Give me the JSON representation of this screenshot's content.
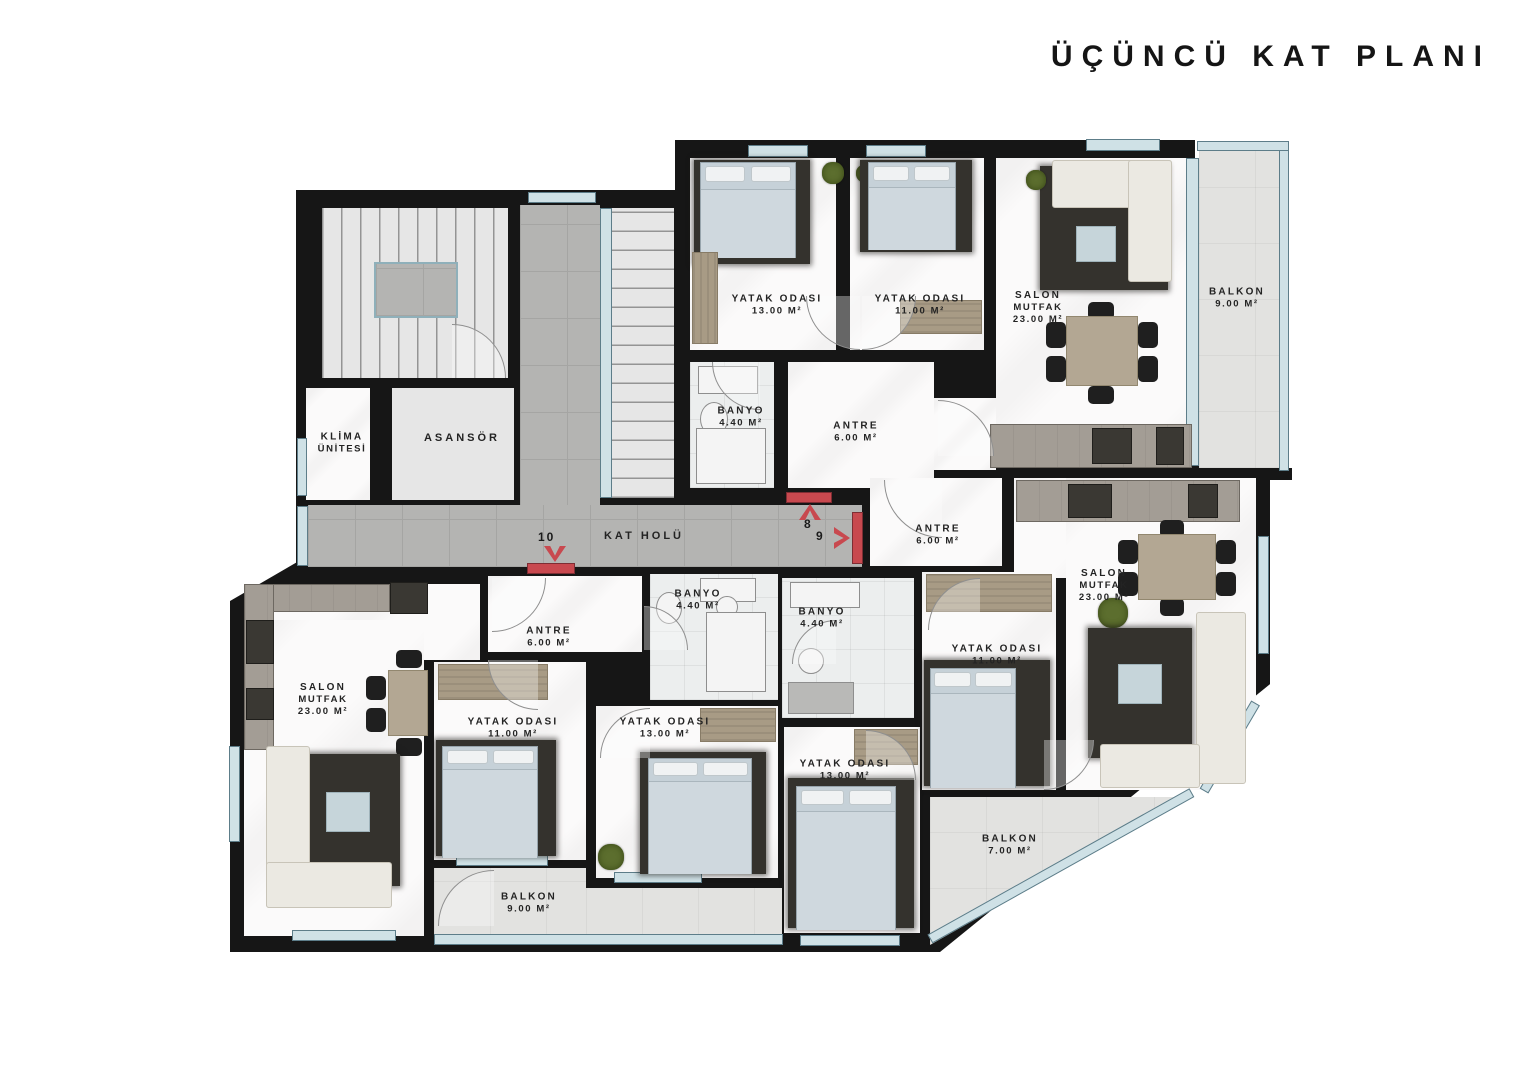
{
  "title": "ÜÇÜNCÜ KAT PLANI",
  "core": {
    "klima_line1": "KLİMA",
    "klima_line2": "ÜNİTESİ",
    "asansor": "ASANSÖR",
    "corridor": "KAT HOLÜ"
  },
  "markers": {
    "up": "8",
    "right": "9",
    "down": "10"
  },
  "rooms": [
    {
      "line1": "YATAK ODASI",
      "area": "13.00 M²"
    },
    {
      "line1": "YATAK ODASI",
      "area": "11.00 M²"
    },
    {
      "line1": "SALON",
      "line2": "MUTFAK",
      "area": "23.00 M²"
    },
    {
      "line1": "BALKON",
      "area": "9.00 M²"
    },
    {
      "line1": "BANYO",
      "area": "4.40 M²"
    },
    {
      "line1": "ANTRE",
      "area": "6.00 M²"
    },
    {
      "line1": "ANTRE",
      "area": "6.00 M²"
    },
    {
      "line1": "SALON",
      "line2": "MUTFAK",
      "area": "23.00 M²"
    },
    {
      "line1": "BANYO",
      "area": "4.40 M²"
    },
    {
      "line1": "YATAK ODASI",
      "area": "11.00 M²"
    },
    {
      "line1": "YATAK ODASI",
      "area": "13.00 M²"
    },
    {
      "line1": "BALKON",
      "area": "7.00 M²"
    },
    {
      "line1": "ANTRE",
      "area": "6.00 M²"
    },
    {
      "line1": "BANYO",
      "area": "4.40 M²"
    },
    {
      "line1": "SALON",
      "line2": "MUTFAK",
      "area": "23.00 M²"
    },
    {
      "line1": "YATAK ODASI",
      "area": "11.00 M²"
    },
    {
      "line1": "YATAK ODASI",
      "area": "13.00 M²"
    },
    {
      "line1": "BALKON",
      "area": "9.00 M²"
    }
  ],
  "colors": {
    "wall": "#161616",
    "accent_red": "#c8494f",
    "glass": "#cfe1e6",
    "corridor_tile": "#b4b4b2",
    "marble": "#fbfafa",
    "balcony": "#e2e2e0"
  }
}
